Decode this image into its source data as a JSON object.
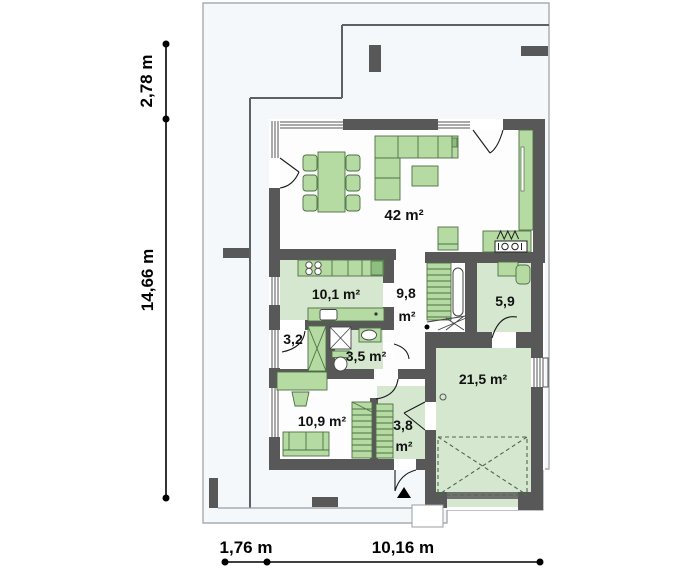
{
  "plan_type": "house-ground-floor-plan",
  "rooms": {
    "living": {
      "name": "living-dining-room",
      "area": "42 m²"
    },
    "kitchen": {
      "name": "kitchen",
      "area": "10,1 m²"
    },
    "hall": {
      "name": "hall",
      "area_value": "9,8",
      "area_unit": "m²"
    },
    "office": {
      "name": "office",
      "area": "5,9"
    },
    "closet": {
      "name": "closet",
      "area": "3,2"
    },
    "bathroom": {
      "name": "bathroom",
      "area": "3,5 m²"
    },
    "bedroom": {
      "name": "bedroom",
      "area": "10,9 m²"
    },
    "entry": {
      "name": "entry",
      "area_value": "3,8",
      "area_unit": "m²"
    },
    "garage": {
      "name": "garage",
      "area": "21,5 m²"
    }
  },
  "dimensions": {
    "terrace_depth": "2,78 m",
    "house_side": "14,66 m",
    "bottom_offset": "1,76 m",
    "house_width": "10,16 m"
  },
  "colors": {
    "wall": "#585858",
    "furniture_fill": "#b5dba3",
    "furniture_stroke": "#4d6f43",
    "room_tint": "#d6e7d0",
    "plot_fill": "#f5f8fa",
    "dimension": "#000000"
  }
}
